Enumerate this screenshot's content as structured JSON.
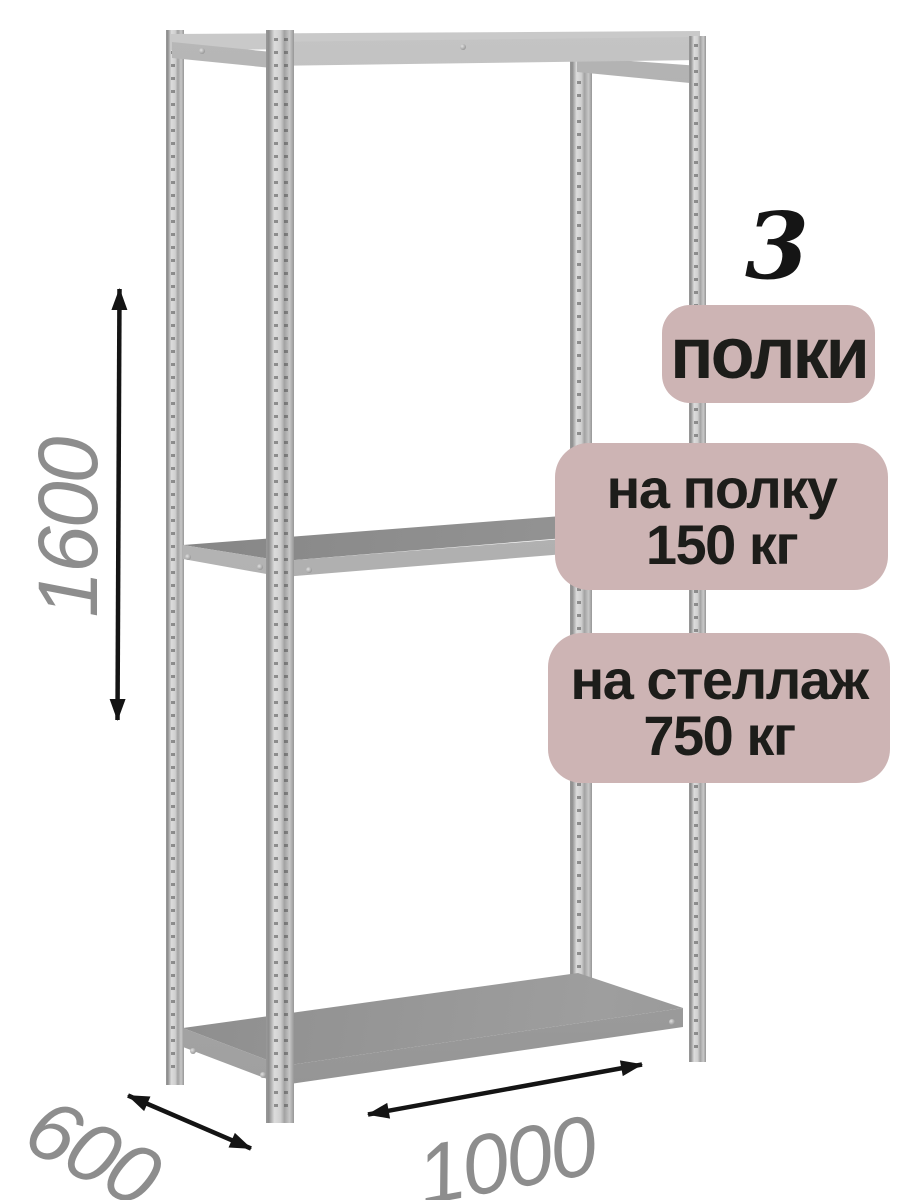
{
  "scene": {
    "subject": "metal-shelving-rack-render",
    "shelves_visible": 3,
    "posts_visible": 4,
    "background_color": "#ffffff"
  },
  "count_callout": {
    "value": "3"
  },
  "badges": [
    {
      "id": "shelf-count",
      "lines": [
        "полки"
      ]
    },
    {
      "id": "per-shelf-load",
      "lines": [
        "на полку",
        "150 кг"
      ]
    },
    {
      "id": "per-rack-load",
      "lines": [
        "на стеллаж",
        "750 кг"
      ]
    }
  ],
  "dimensions": {
    "height": {
      "value": "1600",
      "orientation": "vertical"
    },
    "depth": {
      "value": "600",
      "orientation": "diagonal"
    },
    "width": {
      "value": "1000",
      "orientation": "horizontal"
    }
  },
  "colors": {
    "badge_background": "#cdb4b4",
    "badge_text": "#1d1d1a",
    "count_text": "#151515",
    "dimension_text": "#8d8d8d",
    "arrow": "#141414",
    "metal_light": "#dcdcdc",
    "metal_mid": "#ababab",
    "metal_dark": "#8a8a8a",
    "shelf_surface": "#8f8f8f",
    "shelf_edge": "#b6b6b6"
  }
}
